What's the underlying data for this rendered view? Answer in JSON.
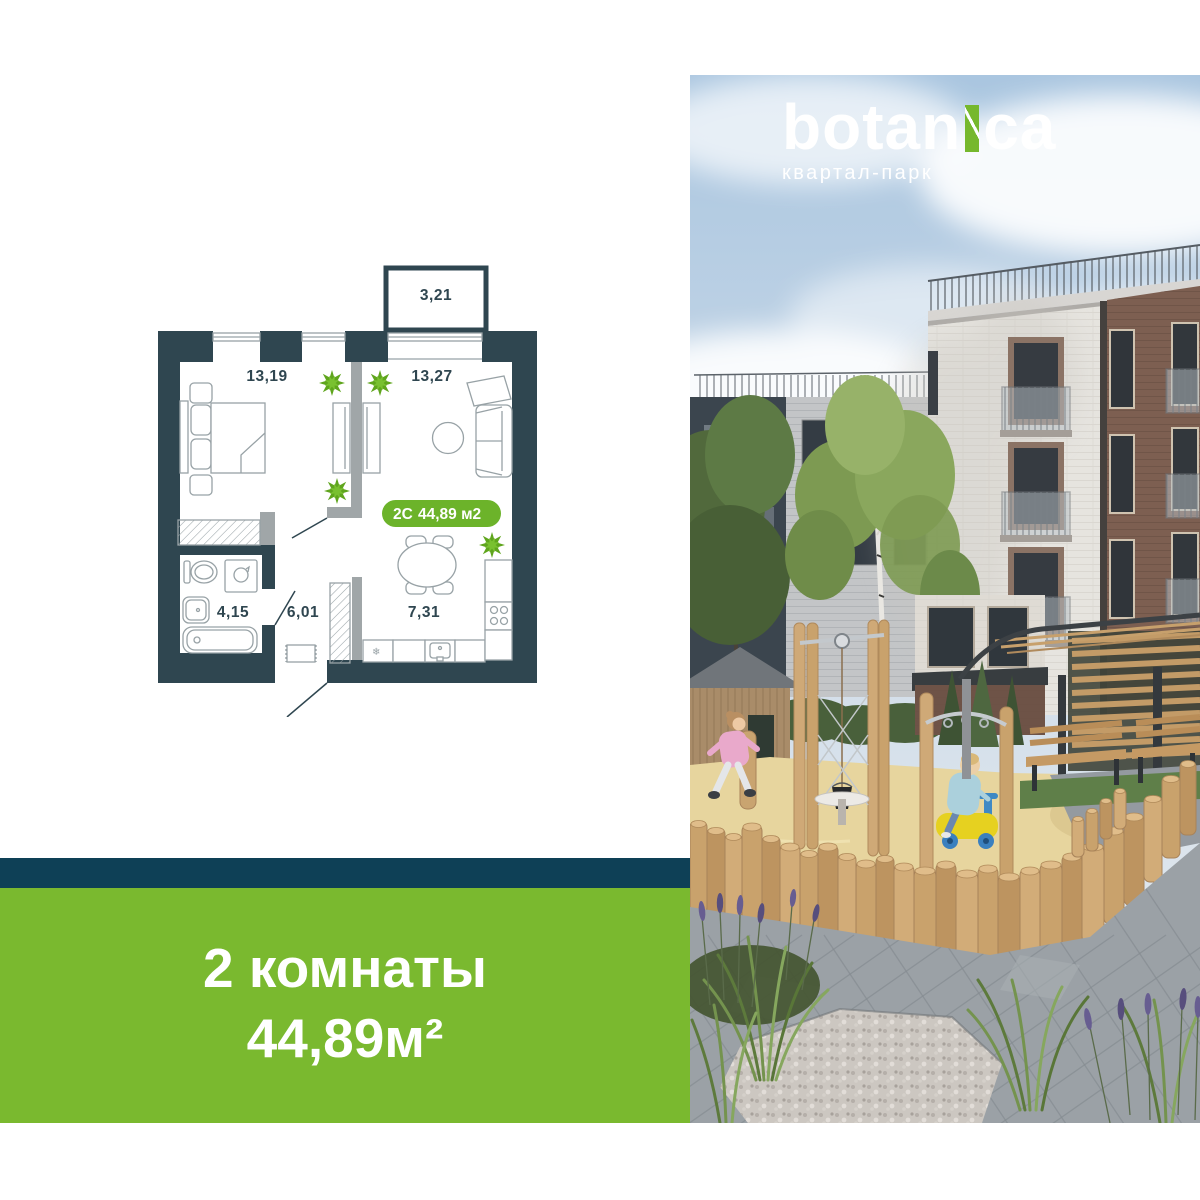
{
  "brand": {
    "name": "botanica",
    "name_part1": "botan",
    "name_part2": "ca",
    "accent_letter": "i",
    "subtitle": "квартал-парк",
    "accent_color": "#76b82d"
  },
  "floorplan": {
    "badge": {
      "type": "2C",
      "area": "44,89 м2",
      "bg_color": "#6cb32a"
    },
    "rooms": [
      {
        "name": "balcony",
        "area": "3,21"
      },
      {
        "name": "bedroom",
        "area": "13,19"
      },
      {
        "name": "living-room",
        "area": "13,27"
      },
      {
        "name": "bathroom",
        "area": "4,15"
      },
      {
        "name": "hallway",
        "area": "6,01"
      },
      {
        "name": "kitchen",
        "area": "7,31"
      }
    ],
    "wall_color": "#2f4650",
    "plant_color": "#61a81e"
  },
  "banner": {
    "line1": "2 комнаты",
    "line2": "44,89м²",
    "bg_color": "#7ab92f",
    "stripe_color": "#0e4056"
  }
}
